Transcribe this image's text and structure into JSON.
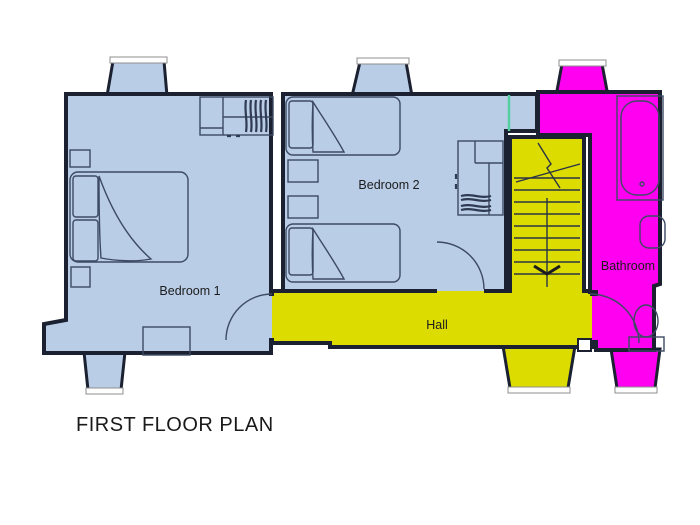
{
  "title": "FIRST FLOOR PLAN",
  "rooms": {
    "bedroom1": {
      "label": "Bedroom 1"
    },
    "bedroom2": {
      "label": "Bedroom 2"
    },
    "hall": {
      "label": "Hall"
    },
    "bathroom": {
      "label": "Bathroom"
    }
  },
  "colors": {
    "bedroom_fill": "#b9cde7",
    "hall_fill": "#dcdc00",
    "bathroom_fill": "#ff00f0",
    "wall": "#1b2130",
    "glass": "#ffffff",
    "window_marker_green": "#54cfa0",
    "label_text": "#1c1c1c",
    "title_text": "#1a1a1a"
  },
  "fixtures": {
    "bedroom1": [
      "double-bed",
      "nightstand",
      "nightstand",
      "wardrobe",
      "chest-of-drawers"
    ],
    "bedroom2": [
      "single-bed",
      "single-bed",
      "nightstand",
      "nightstand",
      "wardrobe"
    ],
    "hall": [
      "staircase-down"
    ],
    "bathroom": [
      "bathtub",
      "sink",
      "toilet"
    ]
  }
}
